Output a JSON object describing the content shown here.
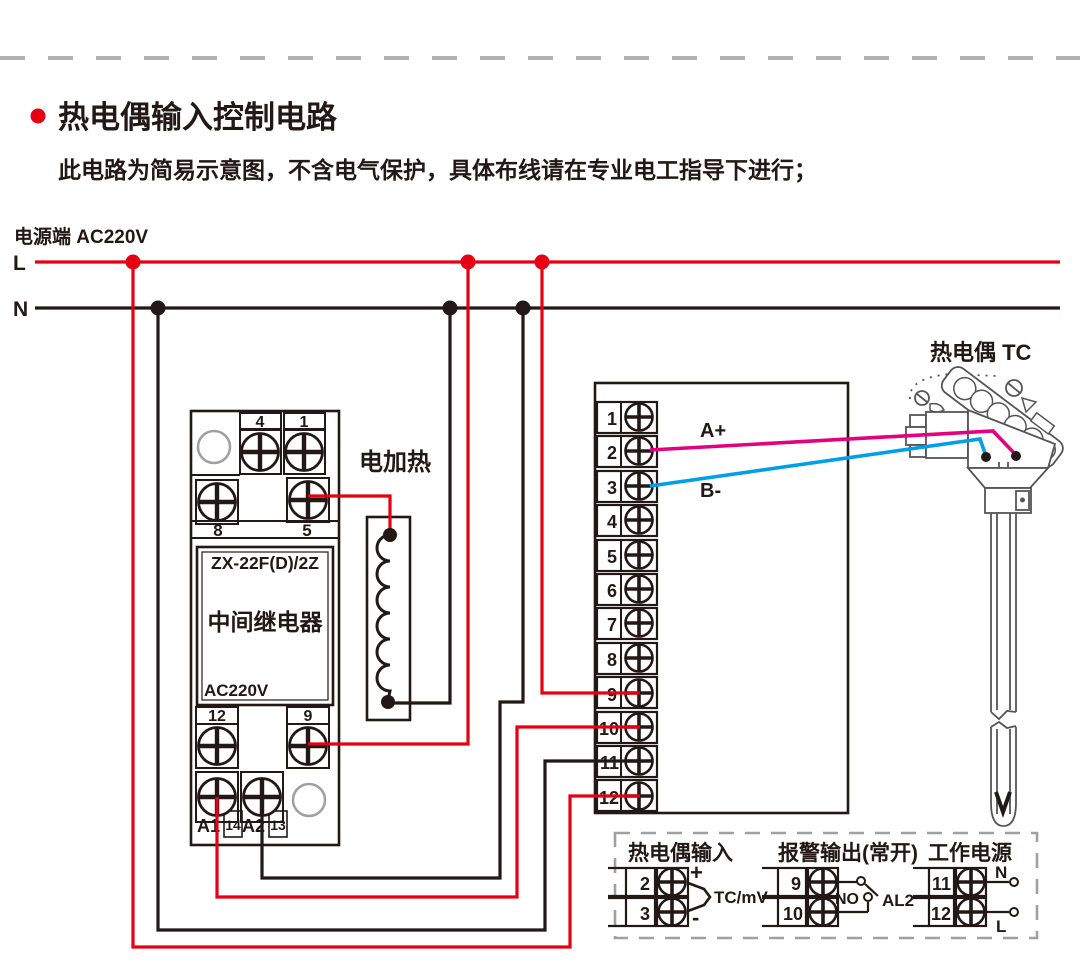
{
  "page": {
    "title": "热电偶输入控制电路",
    "subtitle": "此电路为简易示意图，不含电气保护，具体布线请在专业电工指导下进行；",
    "power_label": "电源端  AC220V"
  },
  "colors": {
    "red": "#e60012",
    "black": "#231815",
    "magenta": "#e4007f",
    "blue": "#00a0e9",
    "gray": "#9fa0a0"
  },
  "power_lines": {
    "live": "L",
    "neutral": "N"
  },
  "relay": {
    "model": "ZX-22F(D)/2Z",
    "name": "中间继电器",
    "voltage": "AC220V",
    "terminals": {
      "t4": "4",
      "t1": "1",
      "t8": "8",
      "t5": "5",
      "t12": "12",
      "t9": "9",
      "a1": "A1",
      "n14": "14",
      "a2": "A2",
      "n13": "13"
    }
  },
  "heater": {
    "label": "电加热"
  },
  "controller": {
    "terminals": [
      "1",
      "2",
      "3",
      "4",
      "5",
      "6",
      "7",
      "8",
      "9",
      "10",
      "11",
      "12"
    ]
  },
  "thermocouple": {
    "label": "热电偶 TC",
    "wire_a": "A+",
    "wire_b": "B-"
  },
  "legend": {
    "input": {
      "title": "热电偶输入",
      "t2": "2",
      "t3": "3",
      "plus": "+",
      "minus": "-",
      "signal": "TC/mV"
    },
    "alarm": {
      "title": "报警输出(常开)",
      "t9": "9",
      "t10": "10",
      "no": "NO",
      "al2": "AL2"
    },
    "power": {
      "title": "工作电源",
      "t11": "11",
      "t12": "12",
      "n": "N",
      "l": "L"
    }
  }
}
